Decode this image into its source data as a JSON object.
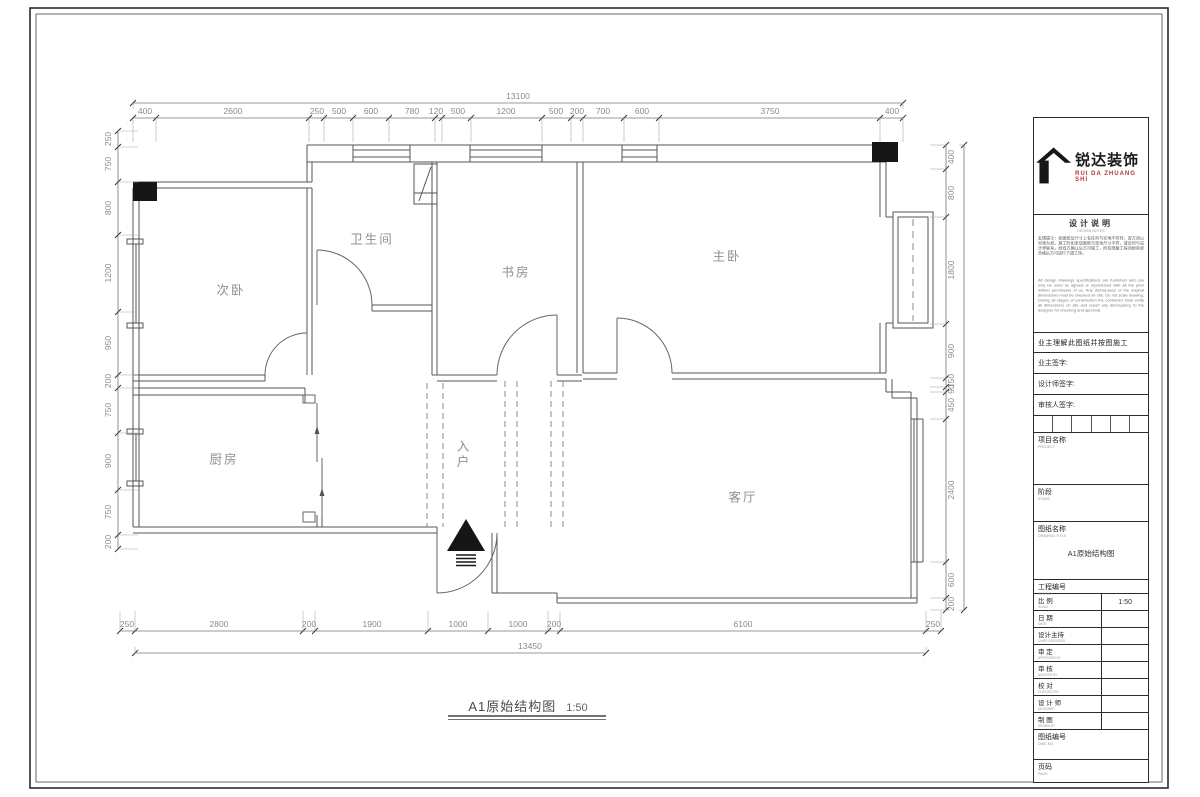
{
  "sheet": {
    "drawing_title": "A1原始结构图",
    "drawing_scale": "1:50"
  },
  "colors": {
    "wall": "#555555",
    "dim_text": "#8a8a8a",
    "ink": "#222222",
    "logo_red": "#b03a2e"
  },
  "rooms": [
    {
      "name": "secondary-bedroom",
      "label": "次卧",
      "x": 231,
      "y": 289
    },
    {
      "name": "bathroom",
      "label": "卫生间",
      "x": 372,
      "y": 238
    },
    {
      "name": "study",
      "label": "书房",
      "x": 516,
      "y": 271
    },
    {
      "name": "master-bedroom",
      "label": "主卧",
      "x": 727,
      "y": 255
    },
    {
      "name": "kitchen",
      "label": "厨房",
      "x": 224,
      "y": 458
    },
    {
      "name": "living-room",
      "label": "客厅",
      "x": 743,
      "y": 496
    },
    {
      "name": "entry",
      "label": "入户",
      "x": 462,
      "y": 455,
      "vertical": true
    }
  ],
  "dim_chains": [
    {
      "id": "top-overall",
      "dir": "h",
      "line": 103,
      "labelOff": -4,
      "ext": 6,
      "ticks": [
        133,
        903
      ],
      "labels": [
        {
          "v": "13100",
          "p": 518
        }
      ]
    },
    {
      "id": "top-segments",
      "dir": "h",
      "line": 118,
      "labelOff": -4,
      "ext": 24,
      "ticks": [
        133,
        156,
        309,
        324,
        353,
        389,
        435,
        442,
        471,
        542,
        571,
        583,
        624,
        659,
        880,
        903
      ],
      "labels": [
        {
          "v": "400",
          "p": 145
        },
        {
          "v": "2600",
          "p": 233
        },
        {
          "v": "250",
          "p": 317
        },
        {
          "v": "500",
          "p": 339
        },
        {
          "v": "600",
          "p": 371
        },
        {
          "v": "780",
          "p": 412
        },
        {
          "v": "120",
          "p": 436
        },
        {
          "v": "500",
          "p": 458
        },
        {
          "v": "1200",
          "p": 506
        },
        {
          "v": "500",
          "p": 556
        },
        {
          "v": "200",
          "p": 577
        },
        {
          "v": "700",
          "p": 603
        },
        {
          "v": "600",
          "p": 642
        },
        {
          "v": "3750",
          "p": 770
        },
        {
          "v": "400",
          "p": 892
        }
      ]
    },
    {
      "id": "bottom-segments",
      "dir": "h",
      "line": 631,
      "labelOff": -4,
      "ext": -20,
      "ticks": [
        120,
        135,
        303,
        315,
        428,
        488,
        548,
        560,
        926,
        941
      ],
      "labels": [
        {
          "v": "250",
          "p": 127
        },
        {
          "v": "2800",
          "p": 219
        },
        {
          "v": "200",
          "p": 309
        },
        {
          "v": "1900",
          "p": 372
        },
        {
          "v": "1000",
          "p": 458
        },
        {
          "v": "1000",
          "p": 518
        },
        {
          "v": "200",
          "p": 554
        },
        {
          "v": "6100",
          "p": 743
        },
        {
          "v": "250",
          "p": 933
        }
      ]
    },
    {
      "id": "bottom-overall",
      "dir": "h",
      "line": 653,
      "labelOff": -4,
      "ext": -6,
      "ticks": [
        135,
        926
      ],
      "labels": [
        {
          "v": "13450",
          "p": 530
        }
      ]
    },
    {
      "id": "left",
      "dir": "v",
      "line": 118,
      "labelOff": -7,
      "ext": 20,
      "ticks": [
        131,
        147,
        182,
        235,
        312,
        375,
        388,
        433,
        490,
        535,
        549
      ],
      "labels": [
        {
          "v": "250",
          "p": 139
        },
        {
          "v": "750",
          "p": 164
        },
        {
          "v": "800",
          "p": 208
        },
        {
          "v": "1200",
          "p": 273
        },
        {
          "v": "950",
          "p": 343
        },
        {
          "v": "200",
          "p": 381
        },
        {
          "v": "750",
          "p": 410
        },
        {
          "v": "900",
          "p": 461
        },
        {
          "v": "750",
          "p": 512
        },
        {
          "v": "200",
          "p": 542
        }
      ]
    },
    {
      "id": "right",
      "dir": "v",
      "line": 946,
      "labelOff": 8,
      "ext": -16,
      "ticks": [
        145,
        169,
        217,
        324,
        378,
        387,
        392,
        419,
        562,
        598,
        610
      ],
      "labels": [
        {
          "v": "400",
          "p": 157
        },
        {
          "v": "800",
          "p": 193
        },
        {
          "v": "1800",
          "p": 270
        },
        {
          "v": "900",
          "p": 351
        },
        {
          "v": "150",
          "p": 381
        },
        {
          "v": "90",
          "p": 389
        },
        {
          "v": "450",
          "p": 405
        },
        {
          "v": "2400",
          "p": 490
        },
        {
          "v": "600",
          "p": 580
        },
        {
          "v": "200",
          "p": 604
        }
      ]
    },
    {
      "id": "right-overall",
      "dir": "v",
      "line": 964,
      "labelOff": 8,
      "ext": -5,
      "ticks": [
        145,
        610
      ],
      "labels": []
    }
  ],
  "title_block": {
    "logo": {
      "cn": "锐达装饰",
      "en": "RUI DA ZHUANG SHI"
    },
    "notes": {
      "heading": "设计说明",
      "sub": "DESIGN NOTES",
      "cn": "友情提示：如图纸及尺寸上有任何与实地不符时，双方须以实地为准。施工时如发现图纸与现场尺寸不符，请及时与设计师联系，经双方确认后方可施工，所有隐蔽工程须经验收合格后方可进行下道工序。",
      "en": "All design drawings specifications are furnished and can only be used as agreed or reproduced with all the prior written permission of us. Any discrepancy of the original dimensions must be checked on site. Do not scale drawing. During all stages of construction the contractor shall verify all dimensions on site and report any discrepancy to the designer for checking and approval."
    },
    "acknowledge": "业主理解此图纸并按图施工",
    "signatures": [
      "业主签字:",
      "设计师签字:",
      "审核人签字:"
    ],
    "project": {
      "label": "项目名称",
      "sub": "PROJECT"
    },
    "stage": {
      "label": "阶段",
      "sub": "STAGE"
    },
    "drawing": {
      "label": "图纸名称",
      "sub": "DRAWING TITLE",
      "value": "A1原始结构图"
    },
    "job": {
      "label": "工程编号",
      "sub": "JOB NO."
    },
    "scale": {
      "label": "比 例",
      "sub": "SCALE",
      "value": "1:50"
    },
    "date": {
      "label": "日 期",
      "sub": "DATE"
    },
    "rows": [
      {
        "label": "设计主持",
        "sub": "CHIEF DESIGNER"
      },
      {
        "label": "审 定",
        "sub": "APPROVED BY"
      },
      {
        "label": "审 核",
        "sub": "AUDITED BY"
      },
      {
        "label": "校 对",
        "sub": "CHECKED BY"
      },
      {
        "label": "设 计 师",
        "sub": "DESIGNER"
      },
      {
        "label": "制 图",
        "sub": "DRAWN BY"
      }
    ],
    "dwg_no": {
      "label": "图纸编号",
      "sub": "DWG NO."
    },
    "page": {
      "label": "页码",
      "sub": "PAGE"
    }
  }
}
